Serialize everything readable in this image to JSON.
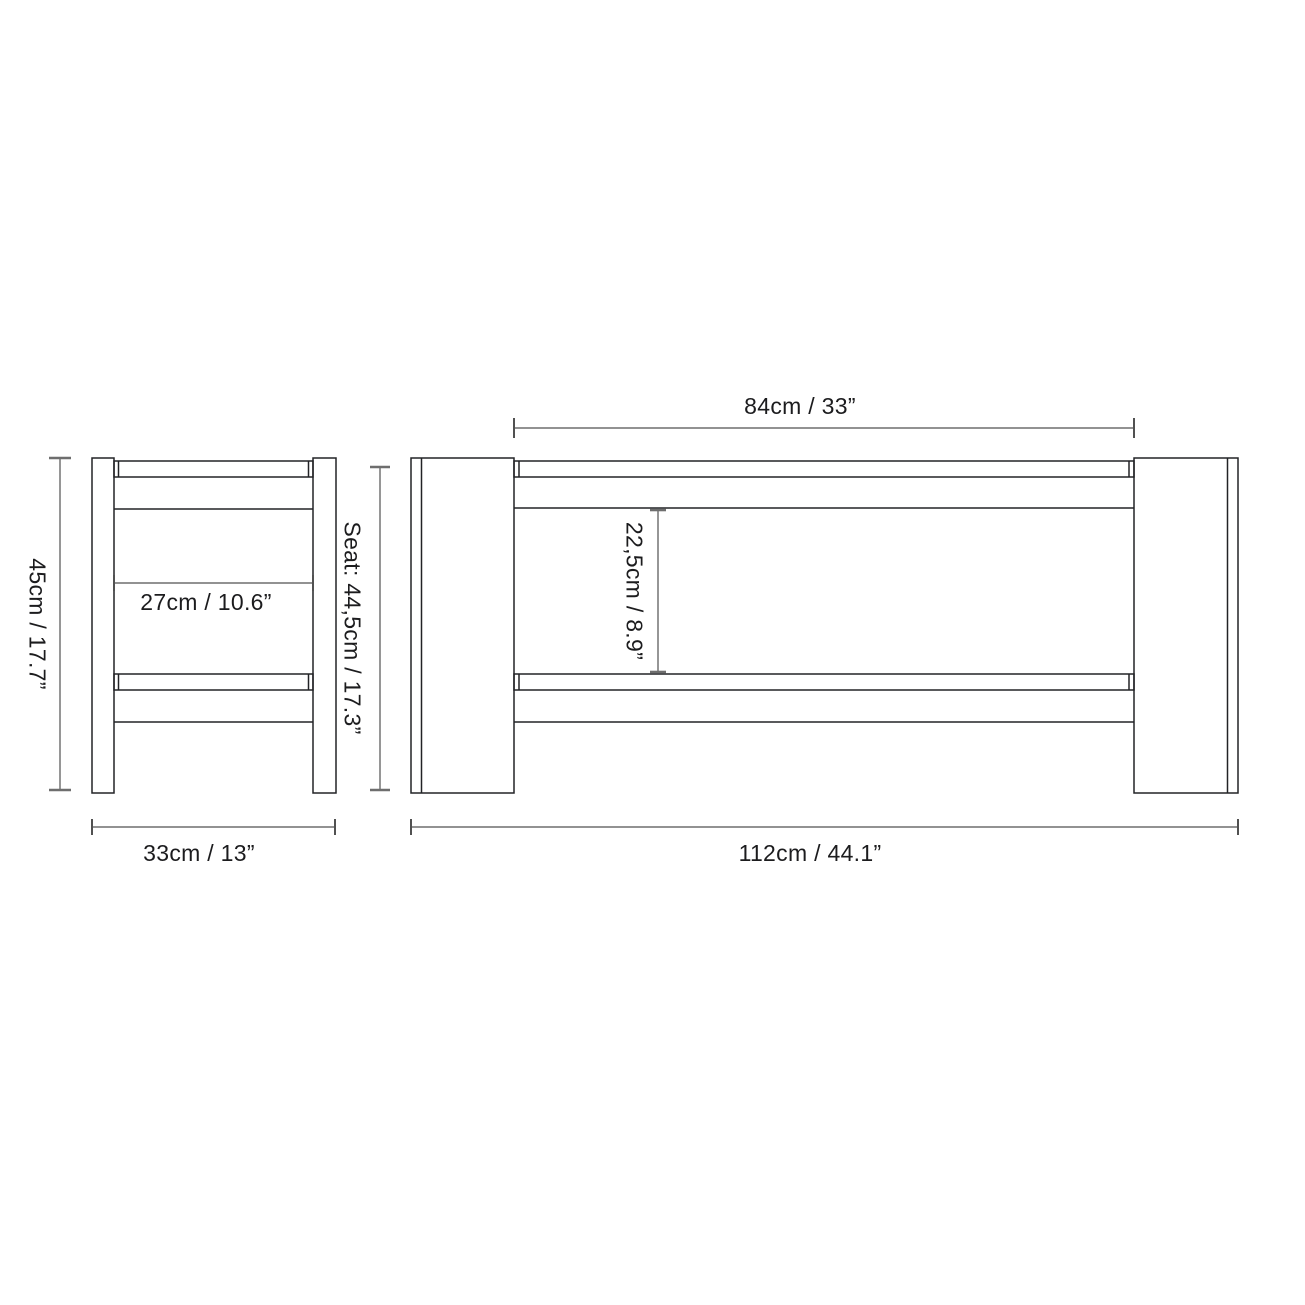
{
  "diagram": {
    "kind": "furniture-dimension-drawing",
    "views": [
      {
        "name": "side-view",
        "description_of_pixels": "bench seen from the side: two legs, seat board, lower stretcher"
      },
      {
        "name": "front-view",
        "description_of_pixels": "bench seen from the front: two leg panels, seat board, lower stretcher"
      }
    ]
  },
  "labels": {
    "height": "45cm / 17.7”",
    "side_inner_width": "27cm / 10.6”",
    "depth": "33cm / 13”",
    "seat_height": "Seat: 44,5cm / 17.3”",
    "top_span": "84cm / 33”",
    "rail_gap": "22,5cm / 8.9”",
    "length": "112cm / 44.1”"
  },
  "dimensions": [
    {
      "name": "overall-height",
      "view": "side-view",
      "orientation": "vertical",
      "label": "45cm / 17.7”",
      "cm": 45,
      "inches": 17.7
    },
    {
      "name": "inner-leg-span-side",
      "view": "side-view",
      "orientation": "horizontal",
      "label": "27cm / 10.6”",
      "cm": 27,
      "inches": 10.6
    },
    {
      "name": "overall-depth",
      "view": "side-view",
      "orientation": "horizontal",
      "label": "33cm / 13”",
      "cm": 33,
      "inches": 13
    },
    {
      "name": "seat-height",
      "view": "front-view",
      "orientation": "vertical",
      "label": "Seat: 44,5cm / 17.3”",
      "cm": 44.5,
      "inches": 17.3
    },
    {
      "name": "inner-leg-span-front",
      "view": "front-view",
      "orientation": "horizontal",
      "label": "84cm / 33”",
      "cm": 84,
      "inches": 33
    },
    {
      "name": "rail-gap",
      "view": "front-view",
      "orientation": "vertical",
      "label": "22,5cm / 8.9”",
      "cm": 22.5,
      "inches": 8.9
    },
    {
      "name": "overall-length",
      "view": "front-view",
      "orientation": "horizontal",
      "label": "112cm / 44.1”",
      "cm": 112,
      "inches": 44.1
    }
  ],
  "colors": {
    "background": "#ffffff",
    "outline": "#222326",
    "dimension_line": "#515151",
    "text": "#1c1c1e"
  }
}
